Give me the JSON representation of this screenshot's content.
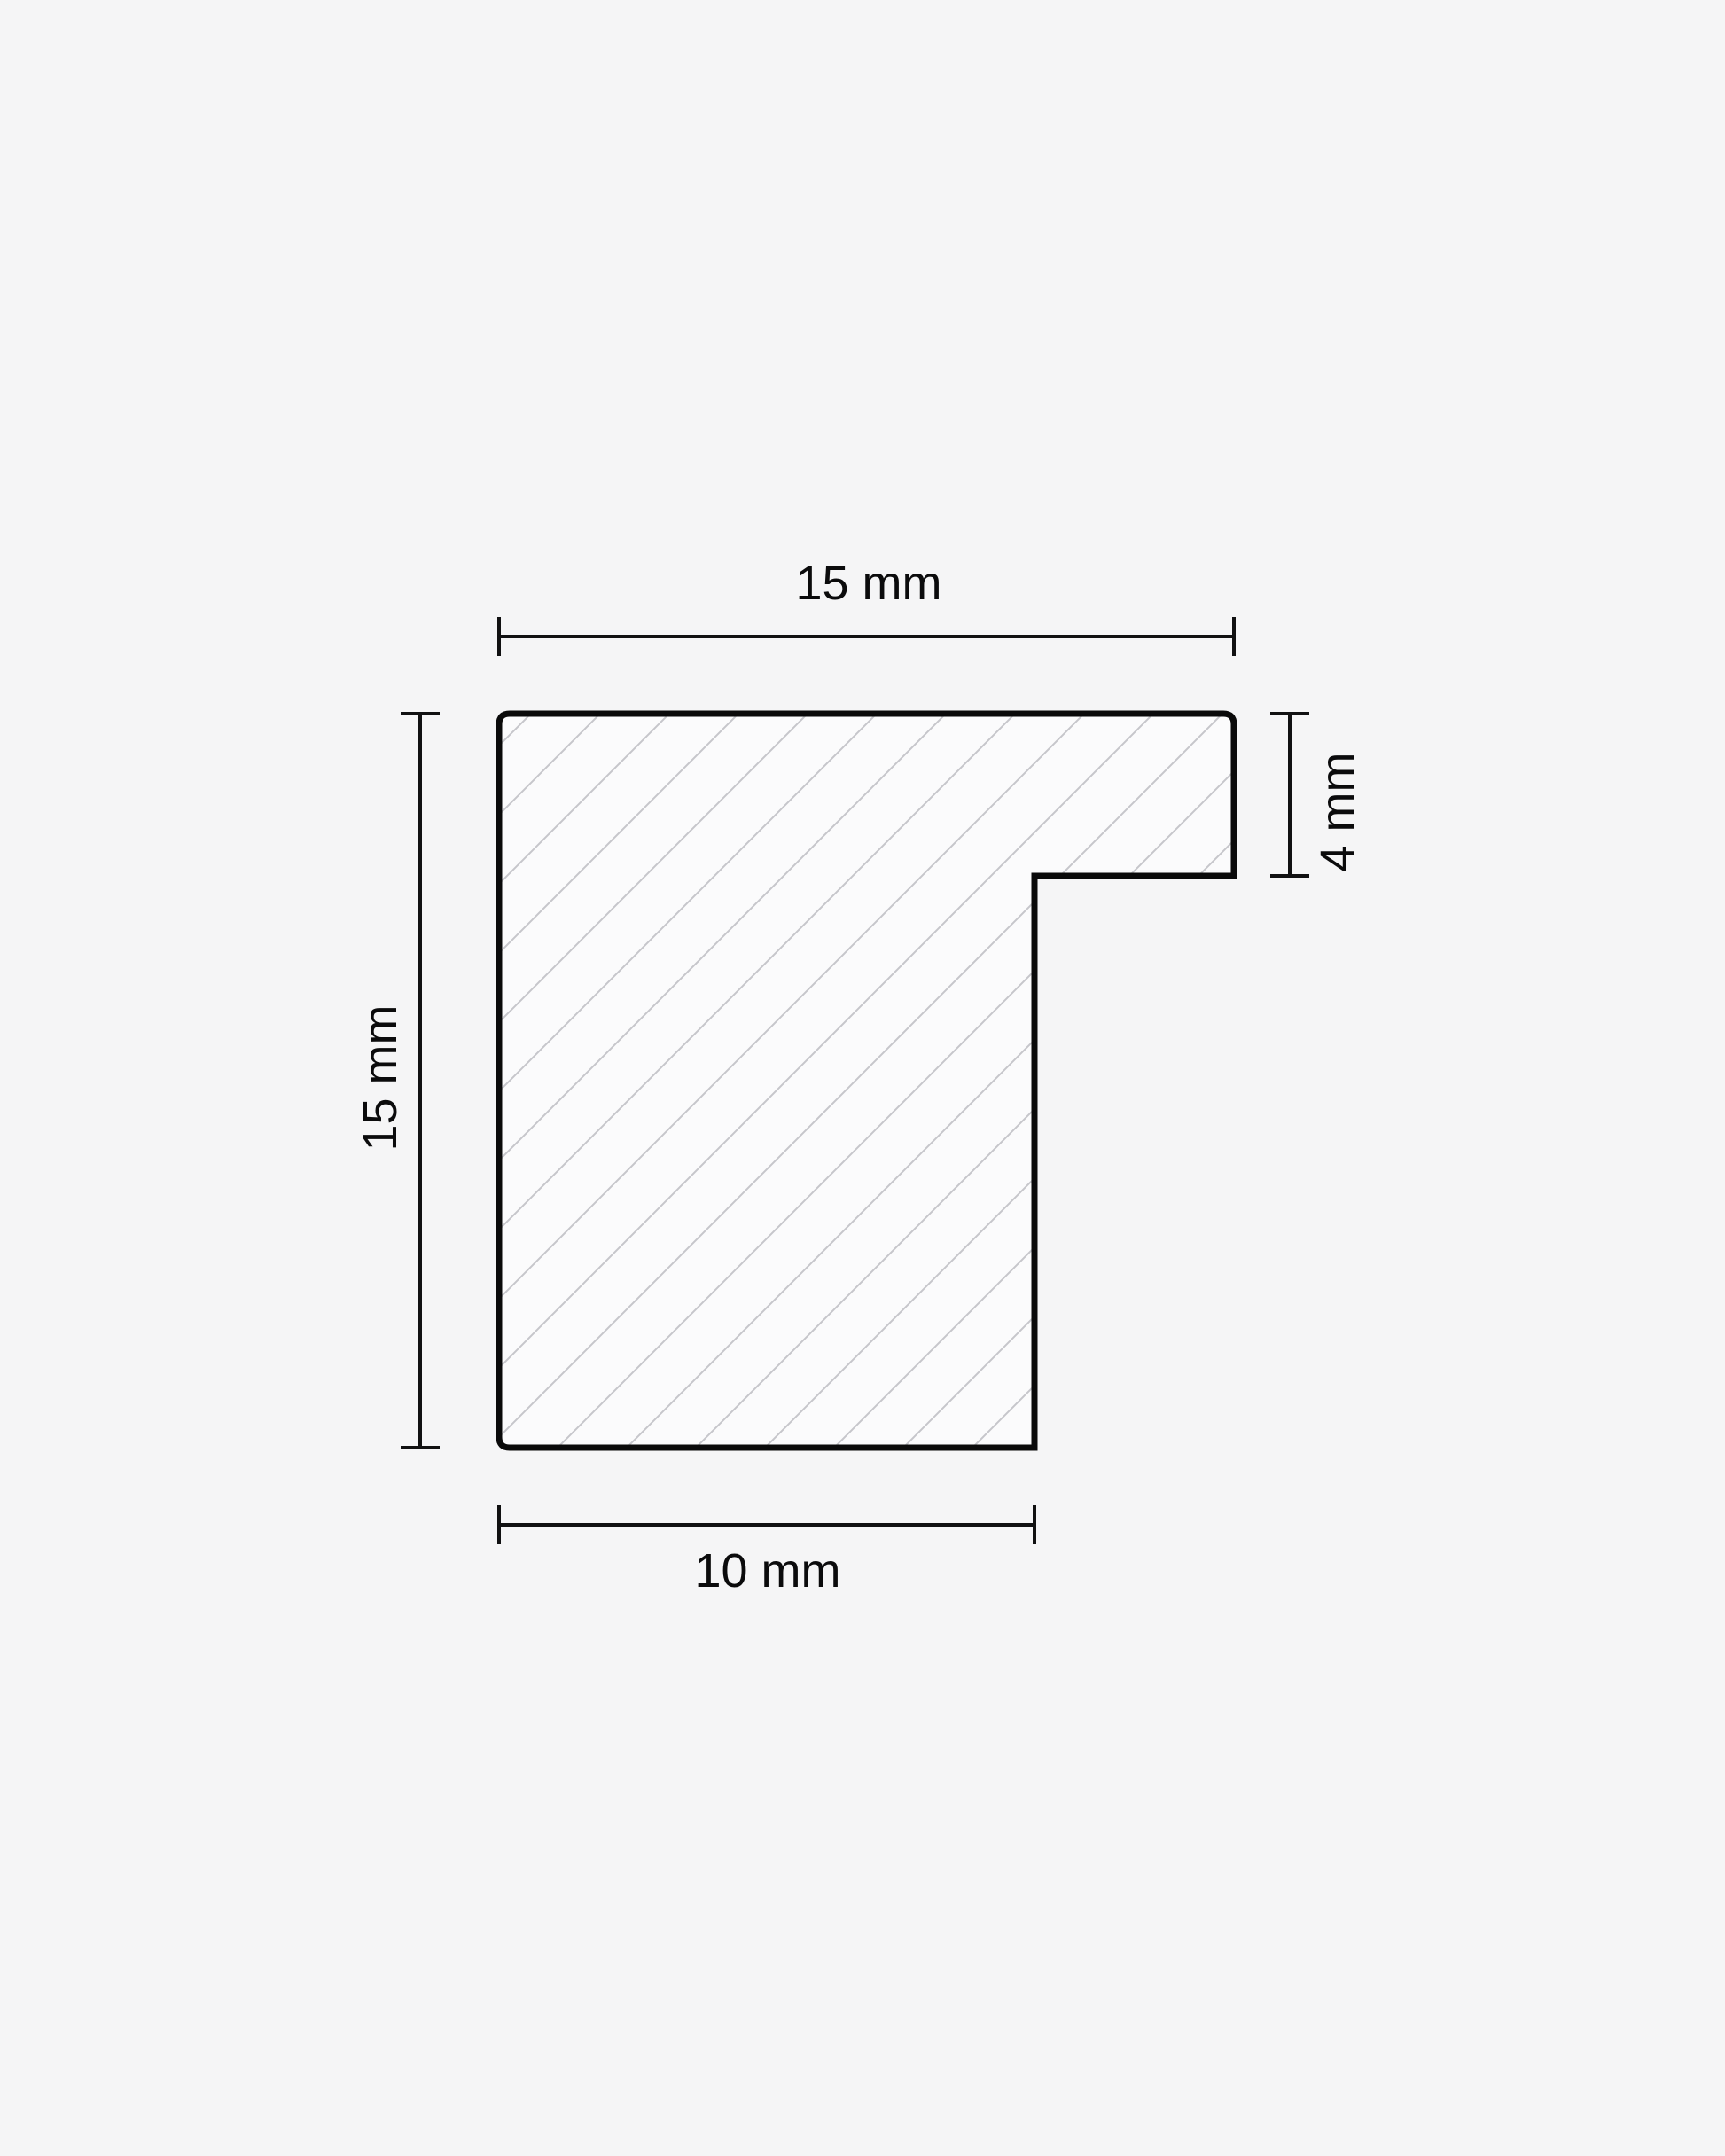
{
  "page": {
    "background_color": "#f5f5f6"
  },
  "diagram": {
    "kind": "moulding-profile-cross-section",
    "colors": {
      "outline": "#0a0a0a",
      "dimension": "#111112",
      "hatch": "#c6c6cb",
      "profile_fill": "#fbfbfc"
    },
    "dimensions": {
      "top": {
        "label": "15 mm",
        "value_mm": 15
      },
      "left": {
        "label": "15 mm",
        "value_mm": 15
      },
      "right": {
        "label": "4 mm",
        "value_mm": 4
      },
      "bottom": {
        "label": "10 mm",
        "value_mm": 10
      }
    }
  }
}
